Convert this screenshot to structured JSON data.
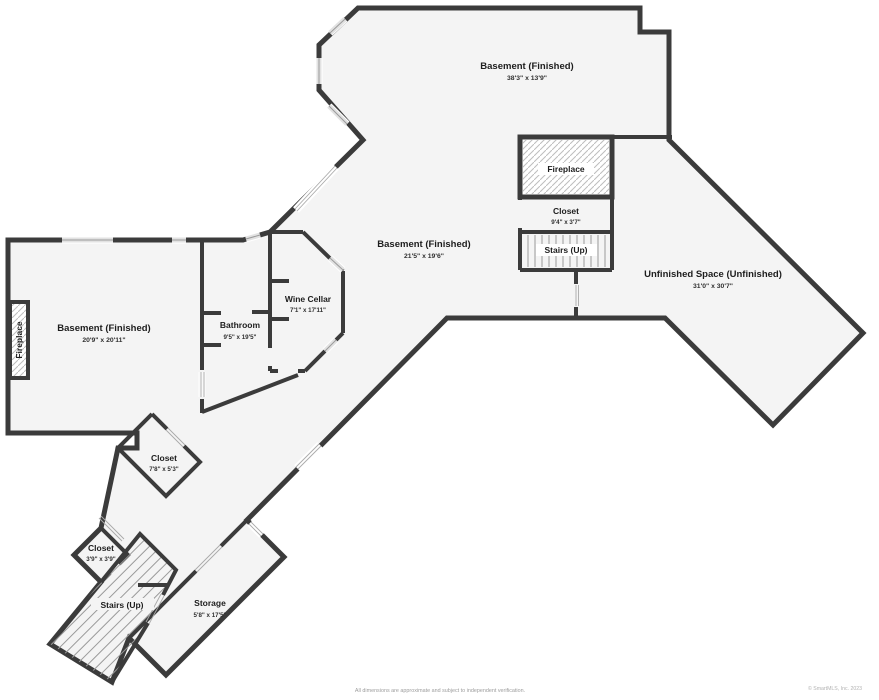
{
  "title": "Basement floor plan",
  "colors": {
    "wall": "#3b3b3b",
    "floor": "#f4f4f4",
    "hatch": "#bdbdbd",
    "opening_line": "#9a9a9a",
    "label_text": "#1d1d1d"
  },
  "rooms": {
    "basement_top": {
      "name": "Basement (Finished)",
      "dims": "38'3\" x 13'9\""
    },
    "basement_mid": {
      "name": "Basement (Finished)",
      "dims": "21'5\" x 19'6\""
    },
    "basement_left": {
      "name": "Basement (Finished)",
      "dims": "20'9\" x 20'11\""
    },
    "unfinished": {
      "name": "Unfinished Space (Unfinished)",
      "dims": "31'0\" x 30'7\""
    },
    "wine_cellar": {
      "name": "Wine Cellar",
      "dims": "7'1\" x 17'11\""
    },
    "bathroom": {
      "name": "Bathroom",
      "dims": "9'5\" x 19'5\""
    },
    "fireplace_top": {
      "name": "Fireplace"
    },
    "closet_top": {
      "name": "Closet",
      "dims": "9'4\" x 3'7\""
    },
    "stairs_top": {
      "name": "Stairs (Up)"
    },
    "fireplace_left": {
      "name": "Fireplace"
    },
    "closet_mid": {
      "name": "Closet",
      "dims": "7'8\" x 5'3\""
    },
    "closet_small": {
      "name": "Closet",
      "dims": "3'9\" x 3'9\""
    },
    "stairs_bottom": {
      "name": "Stairs (Up)"
    },
    "storage": {
      "name": "Storage",
      "dims": "5'8\" x 17'5\""
    }
  },
  "footer": {
    "disclaimer": "All dimensions are approximate and subject to independent verification.",
    "copyright": "© SmartMLS, Inc. 2023"
  }
}
